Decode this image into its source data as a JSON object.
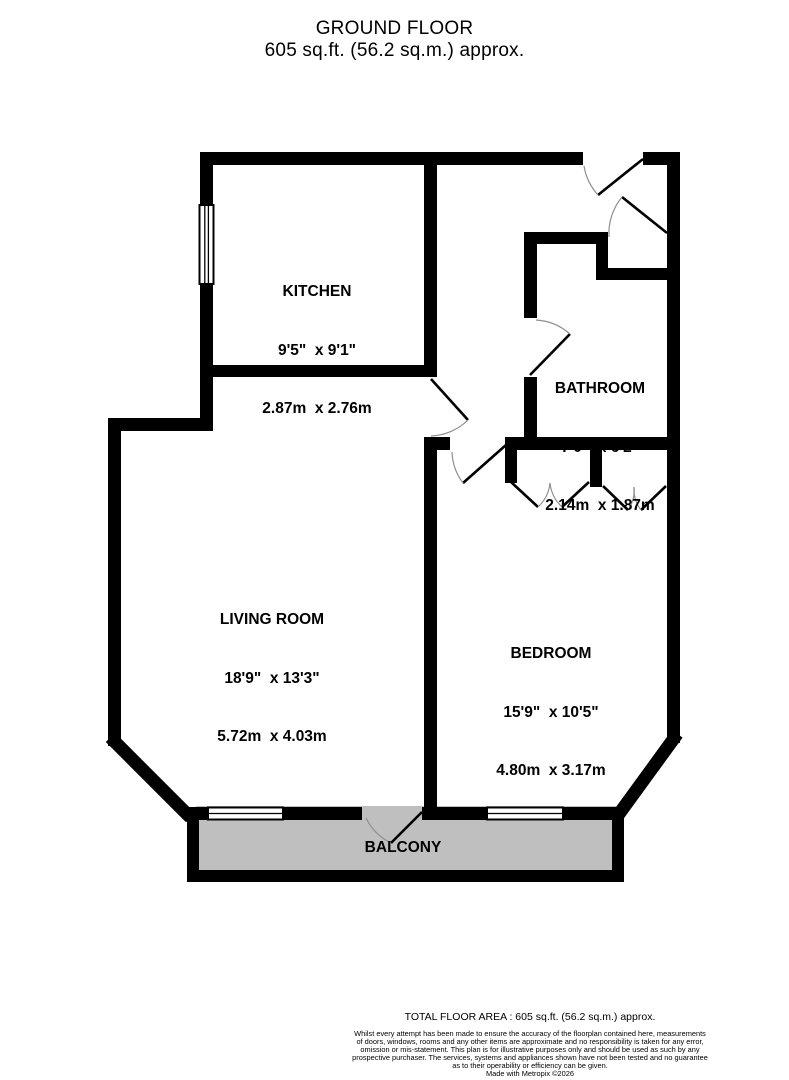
{
  "title": {
    "line1": "GROUND FLOOR",
    "line2": "605 sq.ft. (56.2 sq.m.) approx."
  },
  "rooms": {
    "kitchen": {
      "name": "KITCHEN",
      "imperial": "9'5\"  x 9'1\"",
      "metric": "2.87m  x 2.76m"
    },
    "bathroom": {
      "name": "BATHROOM",
      "imperial": "7'0\"  x 6'2\"",
      "metric": "2.14m  x 1.87m"
    },
    "living_room": {
      "name": "LIVING ROOM",
      "imperial": "18'9\"  x 13'3\"",
      "metric": "5.72m  x 4.03m"
    },
    "bedroom": {
      "name": "BEDROOM",
      "imperial": "15'9\"  x 10'5\"",
      "metric": "4.80m  x 3.17m"
    },
    "balcony": {
      "name": "BALCONY"
    }
  },
  "footer": {
    "total_area": "TOTAL FLOOR AREA : 605 sq.ft. (56.2 sq.m.) approx.",
    "disclaimer": [
      "Whilst every attempt has been made to ensure the accuracy of the floorplan contained here, measurements",
      "of doors, windows, rooms and any other items are approximate and no responsibility is taken for any error,",
      "omission or mis-statement. This plan is for illustrative purposes only and should be used as such by any",
      "prospective purchaser. The services, systems and appliances shown have not been tested and no guarantee",
      "as to their operability or efficiency can be given."
    ],
    "credit": "Made with Metropix ©2026"
  },
  "colors": {
    "wall": "#000000",
    "balcony_fill": "#bfbfbf",
    "door_arc": "#8f8f8f",
    "background": "#ffffff"
  }
}
